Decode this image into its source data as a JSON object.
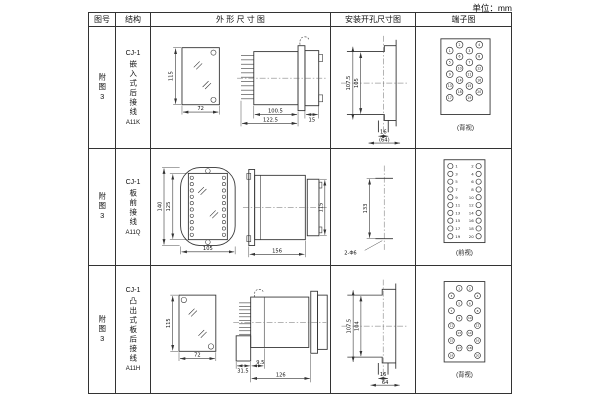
{
  "unit_label": "单位：mm",
  "headers": {
    "fig_no": "图号",
    "structure": "结构",
    "outline": "外 形 尺 寸 图",
    "mounting": "安装开孔尺寸图",
    "terminal": "端子图"
  },
  "rows": [
    {
      "fig_no": "附图3",
      "model": "CJ-1",
      "structure": "嵌入式后接线",
      "code": "A11K",
      "outline": {
        "front_height": "115",
        "front_width": "72",
        "body_depth": "100.5",
        "overall_depth": "122.5",
        "flange_depth": "15"
      },
      "mounting": {
        "outer_height": "107.5",
        "inner_height": "105",
        "slot_width": "16",
        "overall_width": "(64)"
      },
      "terminal": {
        "view_label": "(背视)",
        "terminal_count": 20,
        "numbers": "1-20"
      }
    },
    {
      "fig_no": "附图3",
      "model": "CJ-1",
      "structure": "板前接线",
      "code": "A11Q",
      "outline": {
        "front_outer_height": "140",
        "front_inner_height": "125",
        "front_width": "105",
        "side_width": "156",
        "side_height": "115"
      },
      "mounting": {
        "hole_spacing": "133",
        "holes": "2-Φ6"
      },
      "terminal": {
        "view_label": "(前视)",
        "left_numbers": [
          1,
          3,
          5,
          7,
          9,
          11,
          13,
          15,
          17,
          19
        ],
        "right_numbers": [
          2,
          4,
          6,
          8,
          10,
          12,
          14,
          16,
          18,
          20
        ]
      }
    },
    {
      "fig_no": "附图3",
      "model": "CJ-1",
      "structure": "凸出式板后接线",
      "code": "A11H",
      "outline": {
        "front_height": "115",
        "front_width": "72",
        "base_width": "31.5",
        "gap": "9.5",
        "body_depth": "126"
      },
      "mounting": {
        "outer_height": "107.5",
        "inner_height": "104",
        "slot_width": "16",
        "overall_width": "64"
      },
      "terminal": {
        "view_label": "(背视)",
        "terminal_count": 20,
        "numbers": "1-20"
      }
    }
  ]
}
